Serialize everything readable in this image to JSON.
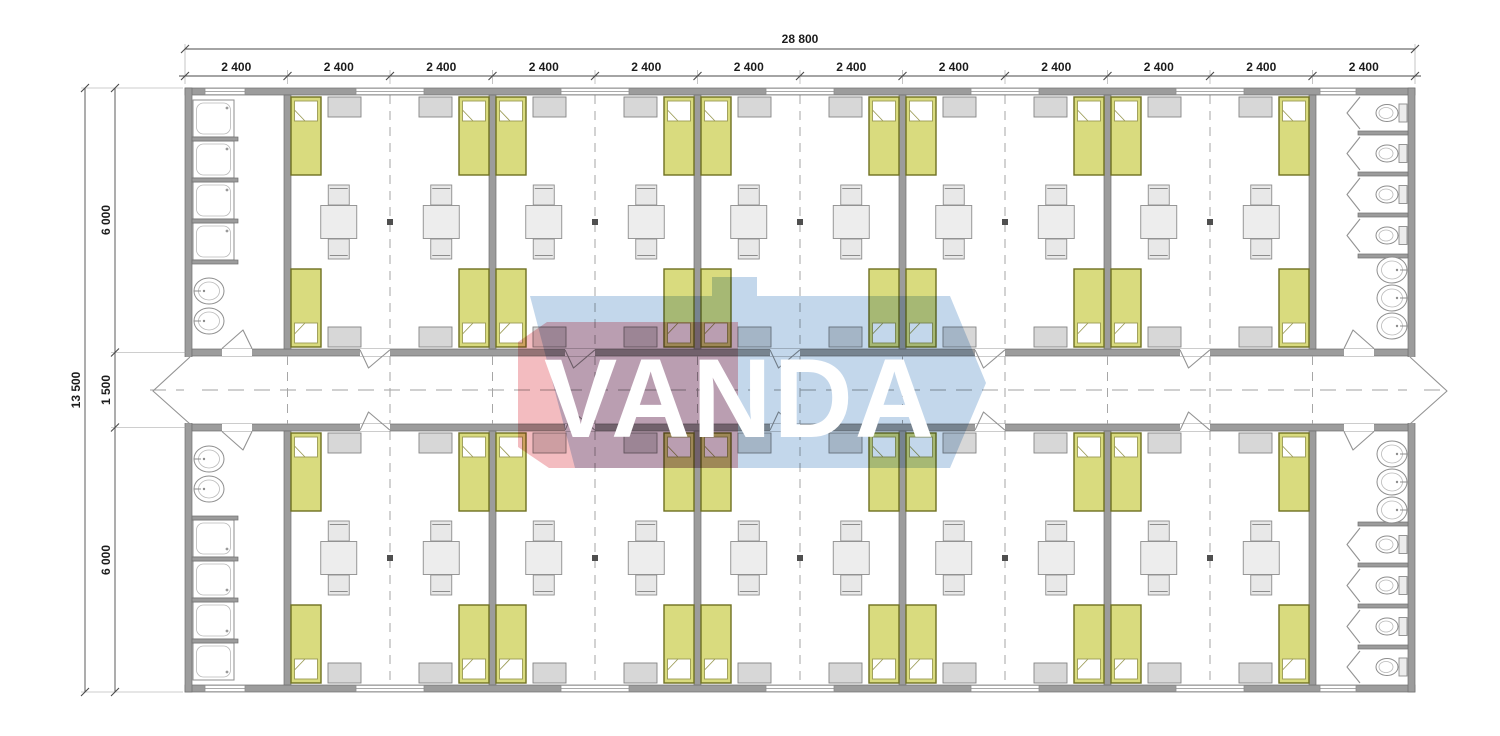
{
  "watermark": {
    "text": "VANDA"
  },
  "dimensions": {
    "overall_width_mm": "28 800",
    "segments_top": [
      "2 400",
      "2 400",
      "2 400",
      "2 400",
      "2 400",
      "2 400",
      "2 400",
      "2 400",
      "2 400",
      "2 400",
      "2 400",
      "2 400"
    ],
    "overall_height_mm": "13 500",
    "segments_left": [
      "6 000",
      "1 500",
      "6 000"
    ]
  },
  "plan_contents": {
    "dorm_rooms": 10,
    "beds": 40,
    "tables_with_chairs": 20,
    "wardrobes": 40,
    "shower_stalls": 8,
    "wc_stalls": 8,
    "sinks": 10,
    "corridor": 1,
    "entrance_doors": 2
  },
  "colors": {
    "wall": "#9c9c9c",
    "bed": "#d9db7e",
    "bed_border": "#6f7021",
    "wardrobe": "#d7d7d7",
    "watermark_red": "rgba(226,96,106,0.42)",
    "watermark_blue": "rgba(122,166,211,0.45)"
  }
}
